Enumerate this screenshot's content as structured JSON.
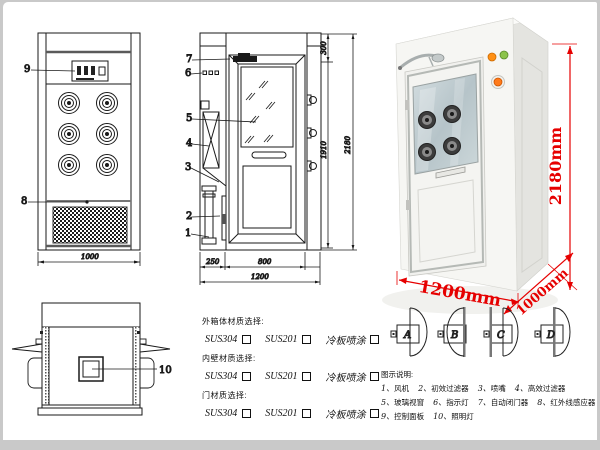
{
  "colors": {
    "line": "#1a1a1a",
    "accent_red": "#e60000",
    "frame_gray": "#c9c9c9"
  },
  "front_view": {
    "label_control_panel": "9",
    "label_grille": "8",
    "dim_width": "1000"
  },
  "side_view": {
    "label_door_closer": "7",
    "label_indicator": "6",
    "label_glass": "5",
    "label_hepa": "4",
    "label_nozzle": "3",
    "label_prefilter": "2",
    "label_fan": "1",
    "dim_top": "300",
    "dim_door_h": "1910",
    "dim_total_h": "2180",
    "dim_step": "250",
    "dim_door_w": "800",
    "dim_total_w": "1200"
  },
  "top_view": {
    "label_lamp": "10"
  },
  "photo": {
    "dim_height": "2180mm",
    "dim_width": "1200mm",
    "dim_depth": "1000mm"
  },
  "materials": {
    "groups": [
      {
        "heading": "外箱体材质选择:",
        "opt1": "SUS304",
        "opt2": "SUS201",
        "opt3": "冷板喷涂"
      },
      {
        "heading": "内壁材质选择:",
        "opt1": "SUS304",
        "opt2": "SUS201",
        "opt3": "冷板喷涂"
      },
      {
        "heading": "门材质选择:",
        "opt1": "SUS304",
        "opt2": "SUS201",
        "opt3": "冷板喷涂"
      }
    ]
  },
  "door_diagrams": {
    "a": "A",
    "b": "B",
    "c": "C",
    "d": "D"
  },
  "legend": {
    "title": "图示说明:",
    "items": [
      {
        "num": "1、",
        "label": "风机"
      },
      {
        "num": "2、",
        "label": "初效过滤器"
      },
      {
        "num": "3、",
        "label": "喷嘴"
      },
      {
        "num": "4、",
        "label": "高效过滤器"
      },
      {
        "num": "5、",
        "label": "玻璃视窗"
      },
      {
        "num": "6、",
        "label": "指示灯"
      },
      {
        "num": "7、",
        "label": "自动闭门器"
      },
      {
        "num": "8、",
        "label": "红外线感应器"
      },
      {
        "num": "9、",
        "label": "控制面板"
      },
      {
        "num": "10、",
        "label": "照明灯"
      }
    ]
  }
}
